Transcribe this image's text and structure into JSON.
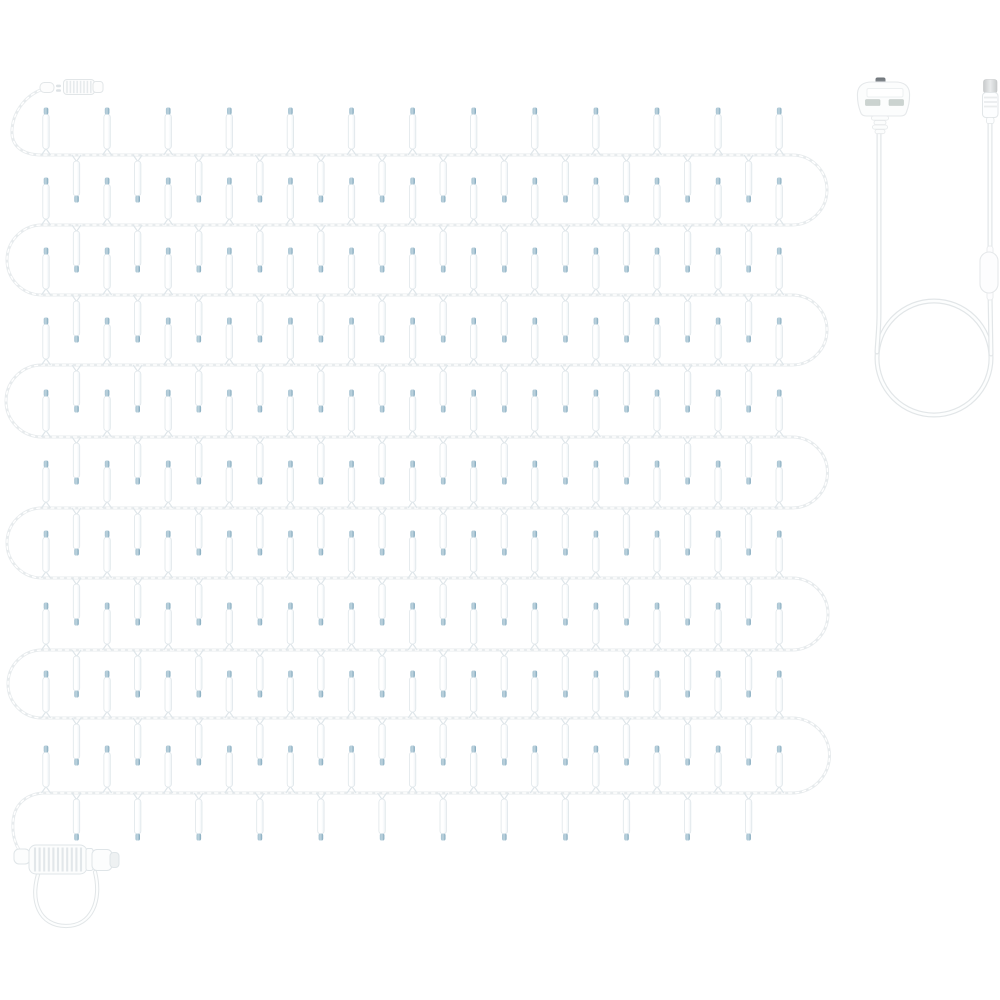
{
  "scene": {
    "background": "#ffffff",
    "description": "Product photo: white-wire incandescent mini string light set arranged in a serpentine grid, with separate white UK mains power lead coiled in a loop",
    "lights": {
      "rows": {
        "count": 10,
        "y_positions": [
          155,
          225,
          295,
          365,
          437,
          508,
          578,
          650,
          718,
          793
        ],
        "x_start": 42,
        "x_end": 792
      },
      "bulbs": {
        "first_x": 46,
        "step": 30.55,
        "per_row": 25,
        "body_length": 35,
        "body_width": 6.4,
        "tip_length": 7,
        "body_light": "#ffffff",
        "body_shade": "#eef3f6",
        "outline": "#dfe6ea",
        "tip_light": "#a5c2d1",
        "tip_mid": "#bdd3de",
        "tip_dark": "#7fa6bb"
      },
      "wire": {
        "base_color": "#e7ebed",
        "highlight_color": "#ffffff",
        "width": 3
      }
    },
    "cable": {
      "base_color": "#e2e6e8",
      "core_color": "#fdfefe",
      "width": 5
    },
    "start_connector": {
      "male_tip": {
        "x": 40,
        "y": 82.5,
        "w": 14,
        "h": 10
      },
      "female_barrel": {
        "x": 63.5,
        "y": 79.5,
        "w": 31,
        "h": 15
      },
      "body_color": "#fdfdfd",
      "outline_color": "#e2e6e8",
      "rib_color": "#e6eaec",
      "pin_color": "#dde2e5"
    },
    "end_connector": {
      "ferrule": {
        "x": 14,
        "y": 849,
        "w": 16,
        "h": 15
      },
      "ribbed_barrel": {
        "x": 29,
        "y": 845,
        "w": 58,
        "h": 29
      },
      "male_plug": {
        "x": 92,
        "y": 849.5,
        "w": 20,
        "h": 21
      },
      "tip_cap": {
        "x": 110,
        "y": 852.5,
        "w": 9,
        "h": 15
      },
      "body_color": "#fcfdfd",
      "outline_color": "#dfe5e8",
      "rib_color": "#e2e7ea",
      "cap_color": "#eef1f2"
    },
    "power_lead": {
      "left_cable_x": 879,
      "right_cable_x": 990,
      "loop": {
        "cx": 934,
        "cy": 358,
        "r": 57
      },
      "uk_plug": {
        "body": {
          "x": 857,
          "y": 82,
          "w": 53,
          "h": 34
        },
        "body_color": "#fcfdfd",
        "outline_color": "#e5e8ea",
        "fuse_bar_color": "#ffffff",
        "pin_color": "#cbd3d0",
        "pin_outline": "#c0cac6",
        "earth_pin_dark": "#6e7479",
        "earth_pin_light": "#9aa1a6"
      },
      "inline_controller": {
        "x": 980,
        "y": 252,
        "w": 18,
        "h": 41,
        "body_color": "#fdfdfe",
        "outline_color": "#e5e8ea"
      },
      "barrel_connector": {
        "cap": {
          "x": 983.5,
          "y": 79.5,
          "w": 13.5,
          "h": 13.5
        },
        "body": {
          "x": 982.5,
          "y": 92.5,
          "w": 15.5,
          "h": 25
        },
        "cap_dark": "#c8cbcc",
        "cap_light": "#e9ebec",
        "body_color": "#fdfeff",
        "outline_color": "#e2e6e8"
      }
    }
  }
}
